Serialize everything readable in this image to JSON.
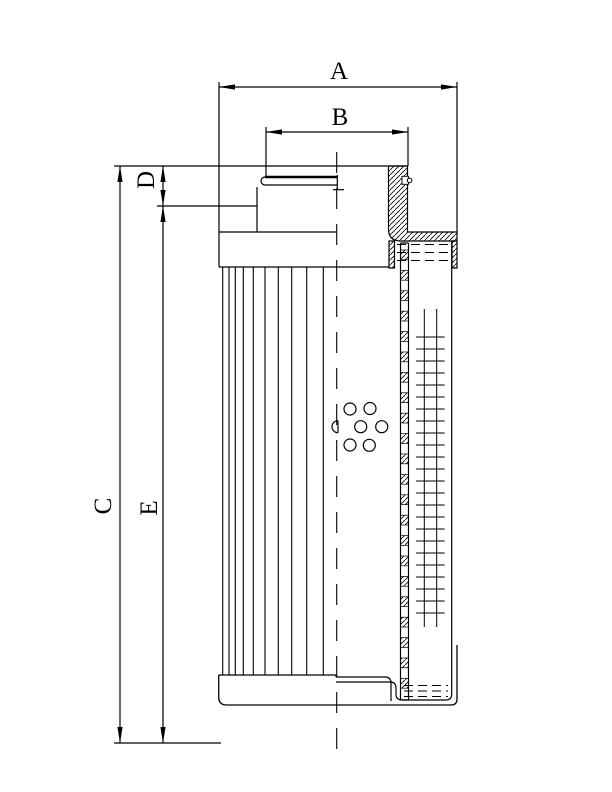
{
  "drawing": {
    "type": "technical-dimension-drawing",
    "subject": "hydraulic filter element cross-section",
    "background_color": "#ffffff",
    "line_color": "#000000",
    "dimension_labels": [
      {
        "id": "dim-label-a",
        "text": "A",
        "x": 339,
        "y": 70,
        "rot": 0
      },
      {
        "id": "dim-label-b",
        "text": "B",
        "x": 340,
        "y": 116,
        "rot": 0
      },
      {
        "id": "dim-label-c",
        "text": "C",
        "x": 102,
        "y": 506,
        "rot": -90
      },
      {
        "id": "dim-label-d",
        "text": "D",
        "x": 145,
        "y": 180,
        "rot": -90
      },
      {
        "id": "dim-label-e",
        "text": "E",
        "x": 148,
        "y": 508,
        "rot": -90
      }
    ],
    "font_size": 25,
    "geometry": {
      "solid_lines": [
        [
          114,
          166,
          219,
          166
        ],
        [
          219,
          166,
          407.5,
          166
        ],
        [
          219,
          166,
          219,
          267
        ],
        [
          219,
          82,
          219,
          166
        ],
        [
          457,
          82,
          457,
          232
        ],
        [
          266,
          127,
          266,
          176
        ],
        [
          408,
          127,
          408,
          166
        ],
        [
          157,
          206,
          257,
          206
        ],
        [
          114,
          743,
          221,
          743
        ],
        [
          120,
          166,
          120,
          743
        ],
        [
          163,
          166,
          163,
          743
        ],
        [
          219,
          87,
          457,
          87
        ],
        [
          266,
          132,
          408,
          132
        ],
        [
          219,
          267,
          389,
          267
        ],
        [
          219,
          232,
          337,
          232
        ],
        [
          257,
          187,
          257,
          232
        ],
        [
          337.3,
          175,
          337.3,
          190
        ],
        [
          333,
          189.7,
          344,
          189.7
        ],
        [
          265,
          177,
          337.3,
          177,
          2.4
        ],
        [
          265,
          185,
          337.3,
          185
        ],
        [
          218.7,
          675,
          336,
          675
        ],
        [
          336,
          675,
          336,
          677
        ],
        [
          391,
          683,
          391,
          701
        ],
        [
          400.5,
          243,
          400.5,
          700
        ],
        [
          408.5,
          243,
          408.5,
          700
        ],
        [
          400.5,
          243,
          408.5,
          243
        ],
        [
          400.5,
          700,
          408.5,
          700
        ],
        [
          338,
          420.7,
          338,
          432.7
        ]
      ],
      "paths": [
        {
          "d": "M265,177 A4,4 0 0 0 265,185",
          "w": 1.2
        },
        {
          "d": "M218.7,675 L218.7,697 Q218.7,705 226.7,705 L451,705 Q457,705 457,699 L457,645",
          "w": 1.3
        },
        {
          "d": "M396,688 L396,694 Q396,700 402,700 L446,700 Q451.7,700 451.7,694 L451.7,241",
          "w": 1.2
        },
        {
          "d": "M336,677 L385,677 Q391,677 391,683",
          "w": 1.2
        },
        {
          "d": "M336,682 L390,682 Q396,682 396,688",
          "w": 1.2
        },
        {
          "d": "M338,420.7 A6,6 0 0 0 338,432.7",
          "w": 1.2
        }
      ],
      "hatched_areas": [
        {
          "d": "M388.5,166 L407.5,166 L407.5,232 L457,232 L457,241 L400.5,241 Q388.5,241 388.5,229 Z"
        },
        {
          "d": "M389,241 L394.5,241 L394.5,268 L389,268 Z"
        },
        {
          "d": "M452,241 L457,241 L457,268 L452,268 Z"
        }
      ],
      "oring_groove": {
        "x": 402,
        "y": 176.3,
        "w": 6.5,
        "h": 8
      },
      "oring_circle": {
        "cx": 409.6,
        "cy": 180.4,
        "r": 2.3
      },
      "dashed_lines": [
        {
          "x1": 336.7,
          "y1": 152,
          "x2": 336.7,
          "y2": 757,
          "dash": "21 15",
          "w": 1.1
        },
        {
          "x1": 397,
          "y1": 244.5,
          "x2": 450,
          "y2": 244.5,
          "dash": "9 5",
          "w": 1
        },
        {
          "x1": 397,
          "y1": 252.5,
          "x2": 450,
          "y2": 252.5,
          "dash": "9 5",
          "w": 1
        },
        {
          "x1": 397,
          "y1": 260.5,
          "x2": 450,
          "y2": 260.5,
          "dash": "9 5",
          "w": 1
        },
        {
          "x1": 404,
          "y1": 685.5,
          "x2": 448,
          "y2": 685.5,
          "dash": "9 5",
          "w": 1
        },
        {
          "x1": 404,
          "y1": 691,
          "x2": 448,
          "y2": 691,
          "dash": "9 5",
          "w": 1
        },
        {
          "x1": 404,
          "y1": 696.5,
          "x2": 448,
          "y2": 696.5,
          "dash": "9 5",
          "w": 1
        }
      ],
      "pleats": {
        "xs": [
          222.7,
          229,
          235.3,
          243.3,
          253.3,
          265,
          278.3,
          291.7,
          306.7,
          323.3
        ],
        "y1": 267,
        "y2": 675,
        "w": 1.1
      },
      "mesh": {
        "vx": [
          424.3,
          436.7
        ],
        "v_y1": 309,
        "v_y2": 627,
        "h_x1": 416,
        "h_x2": 444.7,
        "h_start": 337,
        "h_step": 12,
        "h_count": 24,
        "w": 1
      },
      "perf_column": {
        "x": 400.5,
        "w": 8,
        "seg_start": 250,
        "seg_step": 20.4,
        "seg_h": 9.8,
        "count": 22
      },
      "holes": {
        "r": 6,
        "centers": [
          [
            350,
            409
          ],
          [
            370,
            408.5
          ],
          [
            360.7,
            426.7
          ],
          [
            381.7,
            426.7
          ],
          [
            350,
            445
          ],
          [
            369.3,
            445.3
          ]
        ]
      },
      "arrows": [
        {
          "x": 219,
          "y": 87,
          "dir": "left"
        },
        {
          "x": 457,
          "y": 87,
          "dir": "right"
        },
        {
          "x": 266,
          "y": 132,
          "dir": "left"
        },
        {
          "x": 408,
          "y": 132,
          "dir": "right"
        },
        {
          "x": 120,
          "y": 166,
          "dir": "up"
        },
        {
          "x": 120,
          "y": 743,
          "dir": "down"
        },
        {
          "x": 163,
          "y": 166,
          "dir": "up"
        },
        {
          "x": 163,
          "y": 206,
          "dir": "down"
        },
        {
          "x": 163,
          "y": 206,
          "dir": "up"
        },
        {
          "x": 163,
          "y": 743,
          "dir": "down"
        }
      ],
      "arrow_len": 16,
      "arrow_half_w": 2.6
    }
  }
}
